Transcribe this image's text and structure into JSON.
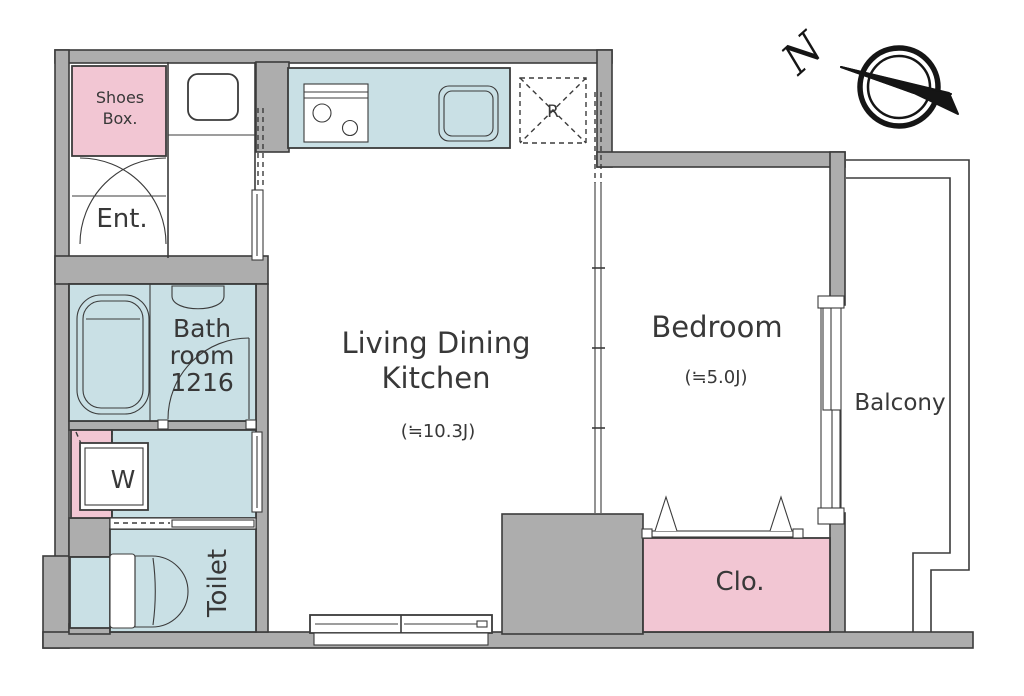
{
  "title": "Apartment floor plan",
  "compass": {
    "label": "N"
  },
  "rooms": {
    "shoes_box": {
      "line1": "Shoes",
      "line2": "Box."
    },
    "entrance": {
      "label": "Ent."
    },
    "bathroom": {
      "line1": "Bath",
      "line2": "room",
      "line3": "1216"
    },
    "washer": {
      "label": "W"
    },
    "toilet": {
      "label": "Toilet"
    },
    "ldk": {
      "line1": "Living Dining",
      "line2": "Kitchen",
      "area": "(≒10.3J)"
    },
    "bedroom": {
      "label": "Bedroom",
      "area": "(≒5.0J)"
    },
    "balcony": {
      "label": "Balcony"
    },
    "closet": {
      "label": "Clo."
    },
    "fridge_space": {
      "label": "R"
    }
  },
  "colors": {
    "wall": "#adadad",
    "water_area": "#c9e0e5",
    "storage_pink": "#f2c6d3",
    "outline": "#3b3b3b",
    "text": "#383838"
  }
}
